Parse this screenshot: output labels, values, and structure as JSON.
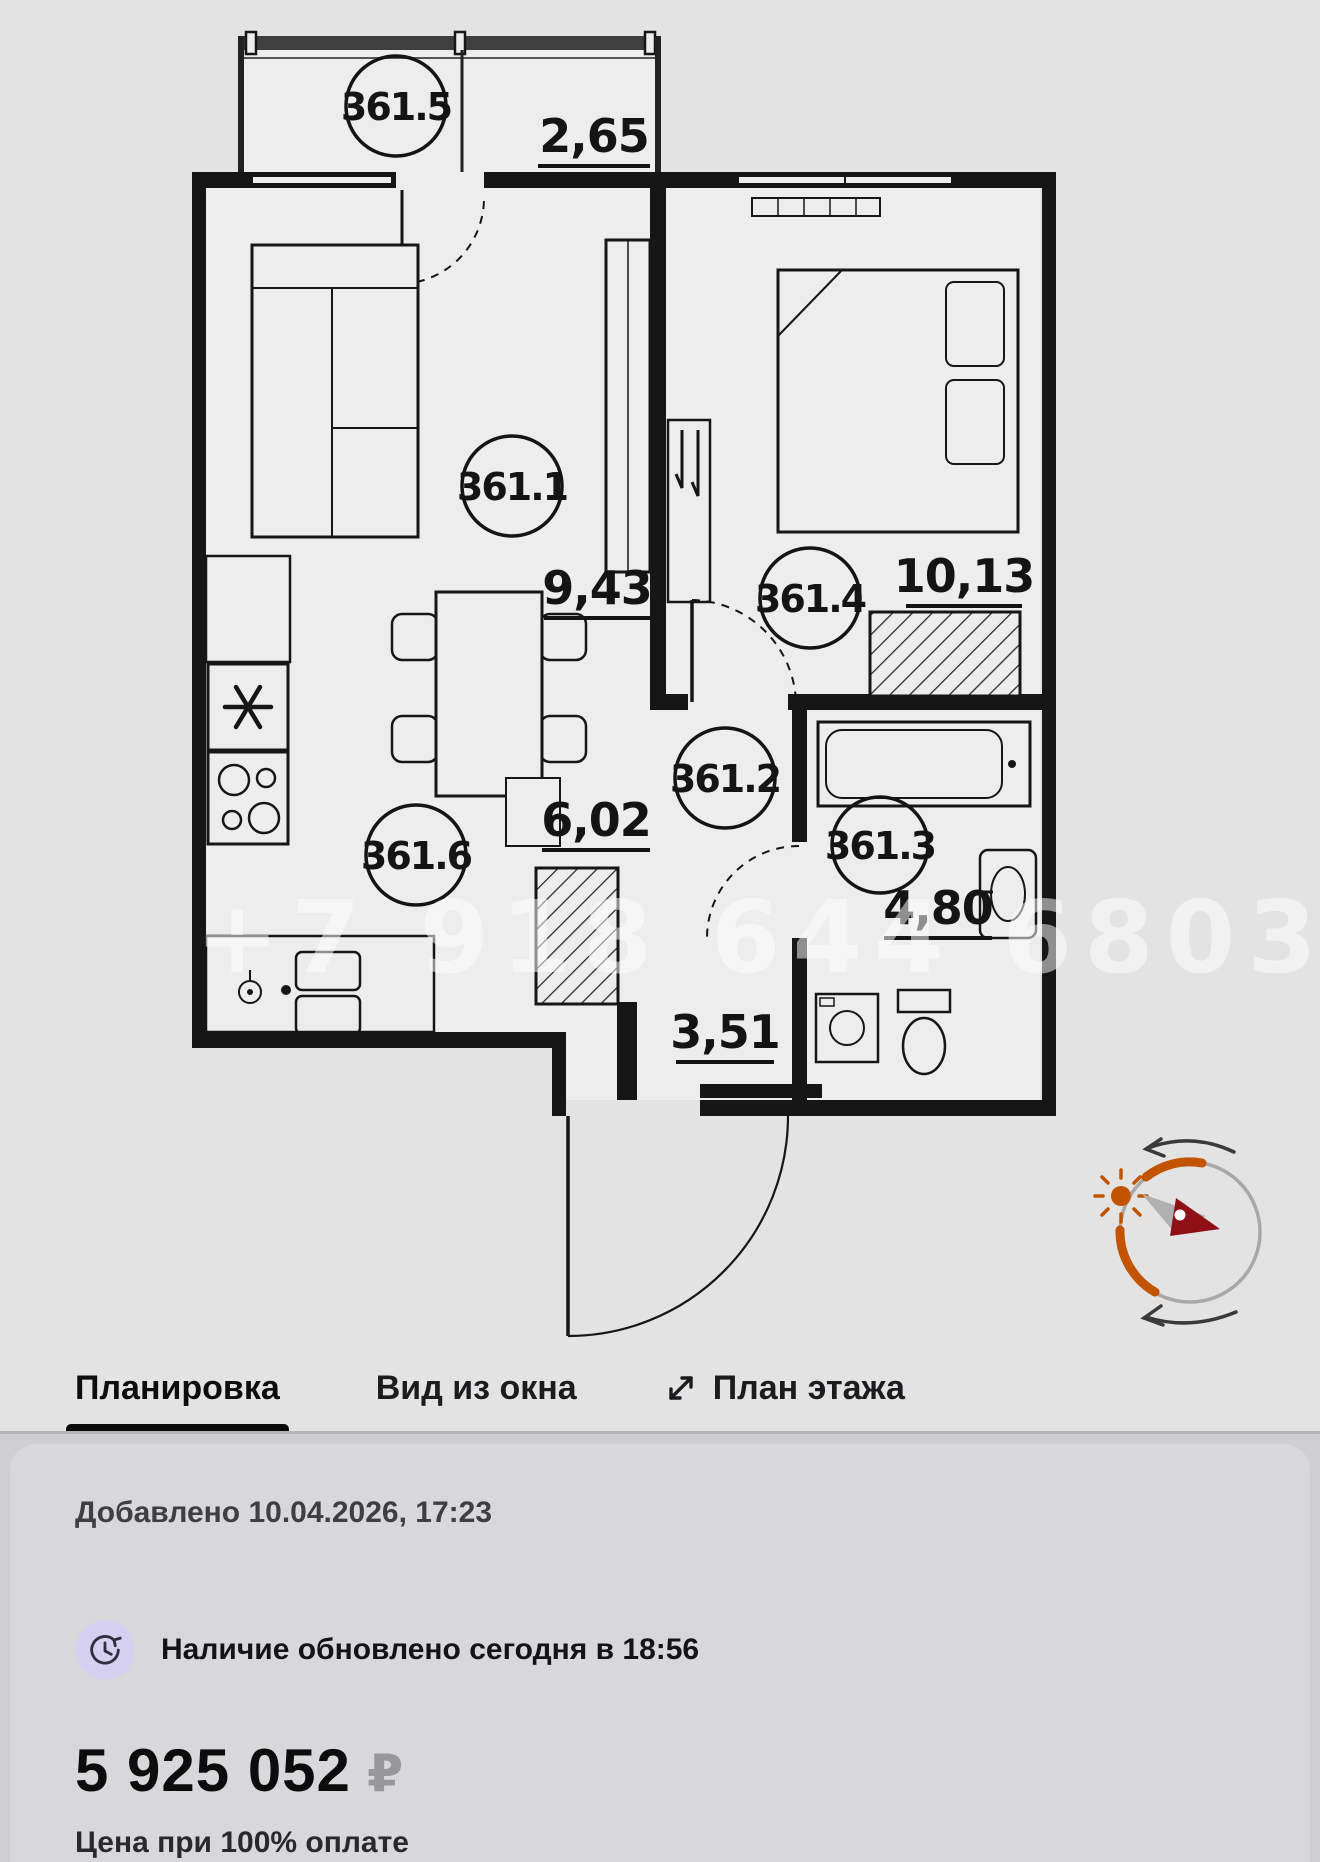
{
  "floor_plan": {
    "watermark": "+7 918 644 6803",
    "rooms": [
      {
        "id": "living",
        "number": "361.1"
      },
      {
        "id": "hallway",
        "number": "361.2"
      },
      {
        "id": "bathroom",
        "number": "361.3"
      },
      {
        "id": "bedroom",
        "number": "361.4"
      },
      {
        "id": "balcony",
        "number": "361.5"
      },
      {
        "id": "kitchen",
        "number": "361.6"
      }
    ],
    "areas": {
      "balcony": "2,65",
      "living": "9,43",
      "bedroom": "10,13",
      "kitchen": "6,02",
      "bathroom": "4,80",
      "hallway": "3,51"
    }
  },
  "tabs": {
    "layout": "Планировка",
    "window_view": "Вид из окна",
    "floor_plan_tab": "План этажа"
  },
  "info": {
    "added": "Добавлено 10.04.2026, 17:23",
    "availability": "Наличие обновлено сегодня в 18:56",
    "price": "5 925 052",
    "currency": "₽",
    "price_note": "Цена при 100% оплате"
  },
  "colors": {
    "compass_orange": "#c25400",
    "needle_red": "#8e1014",
    "clock_badge": "#d6d0f0",
    "active_tab_underline": "#0a0a0a"
  }
}
